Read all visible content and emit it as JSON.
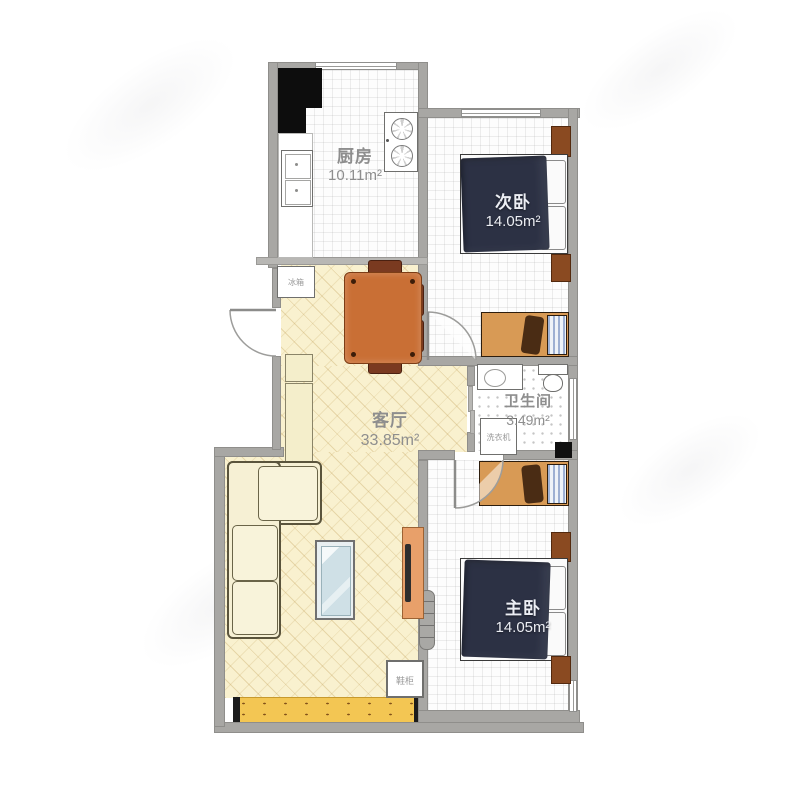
{
  "plan": {
    "title": "三室户型图",
    "rooms": [
      {
        "id": "kitchen",
        "name": "厨房",
        "area": "10.11m²"
      },
      {
        "id": "second-bedroom",
        "name": "次卧",
        "area": "14.05m²"
      },
      {
        "id": "living-room",
        "name": "客厅",
        "area": "33.85m²"
      },
      {
        "id": "bathroom",
        "name": "卫生间",
        "area": "3.49m²"
      },
      {
        "id": "master-bedroom",
        "name": "主卧",
        "area": "14.05m²"
      }
    ],
    "fixture_labels": {
      "fridge": "冰箱",
      "washer": "洗衣机",
      "shoe_cabinet": "鞋柜"
    },
    "colors": {
      "wall": "#a8a7a4",
      "living_floor": "#f9f1cf",
      "balcony_strip": "#f3c653",
      "bed_duvet": "#2c3144",
      "desk": "#d89a55",
      "nightstand": "#8a4a21",
      "dining_table": "#c96f35",
      "dining_chair": "#7a3a20",
      "sofa": "#f6f0d4",
      "tv_stand": "#e8a06a",
      "kitchen_counter": "#0d0d0d",
      "label_text": "#8e8e8e"
    }
  }
}
